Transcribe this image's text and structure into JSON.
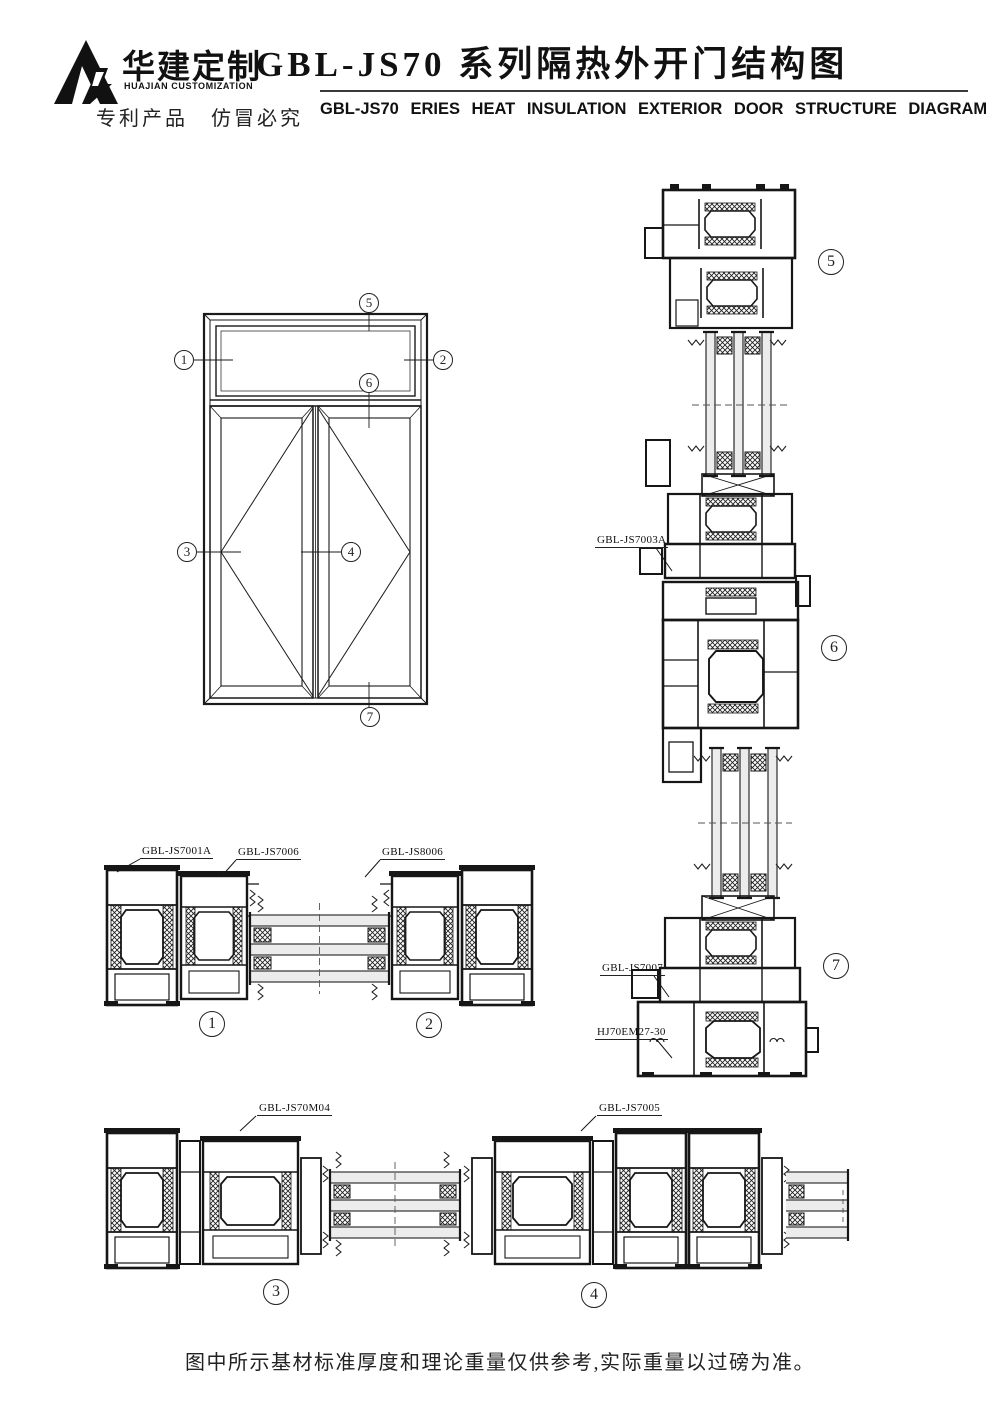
{
  "header": {
    "logo_cn": "华建定制",
    "logo_en": "HUAJIAN CUSTOMIZATION",
    "patent_notice": "专利产品　仿冒必究",
    "title_cn": "GBL-JS70 系列隔热外开门结构图",
    "title_en": "GBL-JS70 ERIES HEAT INSULATION EXTERIOR DOOR STRUCTURE DIAGRAM"
  },
  "elevation": {
    "callouts": {
      "c1": "1",
      "c2": "2",
      "c3": "3",
      "c4": "4",
      "c5": "5",
      "c6": "6",
      "c7": "7"
    }
  },
  "sections": {
    "labels": {
      "js7001a": "GBL-JS7001A",
      "js7006": "GBL-JS7006",
      "js8006": "GBL-JS8006",
      "js70m04": "GBL-JS70M04",
      "js7005": "GBL-JS7005",
      "js7003a": "GBL-JS7003A",
      "js7007": "GBL-JS7007",
      "hj70em2730": "HJ70EM27-30"
    },
    "callouts": {
      "h1": "1",
      "h2": "2",
      "h3": "3",
      "h4": "4",
      "v5": "5",
      "v6": "6",
      "v7": "7"
    }
  },
  "footer": {
    "note": "图中所示基材标准厚度和理论重量仅供参考,实际重量以过磅为准。"
  },
  "colors": {
    "line": "#161616",
    "paper": "#ffffff"
  }
}
